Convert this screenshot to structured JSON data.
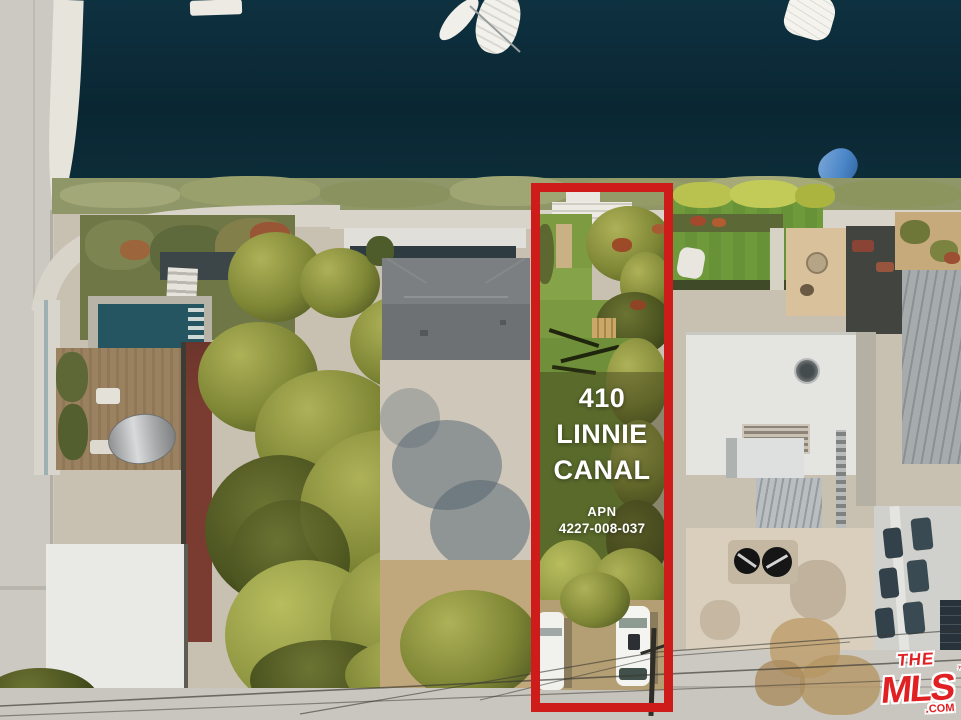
{
  "image_type": "aerial-real-estate-photo",
  "property_overlay": {
    "address_line1": "410",
    "address_line2": "LINNIE",
    "address_line3": "CANAL",
    "apn_label": "APN",
    "apn_value": "4227-008-037"
  },
  "watermark": {
    "the": "THE",
    "mls": "MLS",
    "tm": "™",
    "com": ".COM"
  },
  "colors": {
    "highlight_box_red": "#ce1c1a",
    "overlay_text": "#ffffff",
    "canal_water": "#0b2936",
    "watermark_red": "#e02023"
  }
}
